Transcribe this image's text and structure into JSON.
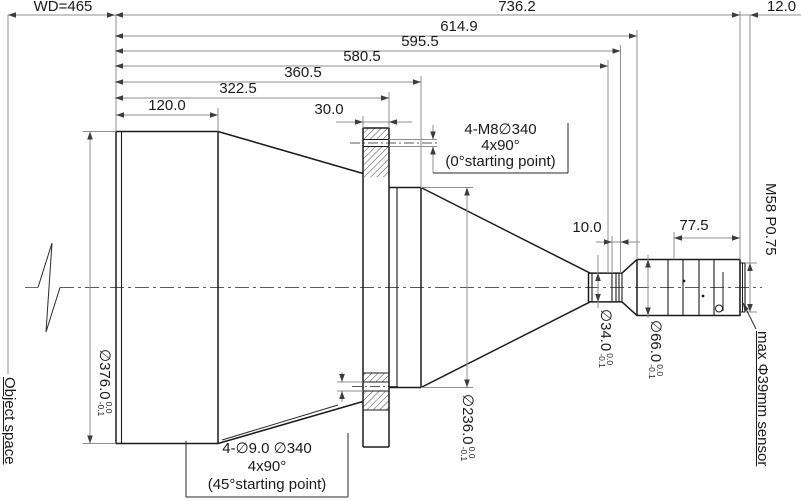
{
  "drawing": {
    "title": "telecentric lens mechanical dimension drawing",
    "dims": {
      "wd": "WD=465",
      "d736": "736.2",
      "d614": "614.9",
      "d595": "595.5",
      "d580": "580.5",
      "d360": "360.5",
      "d322": "322.5",
      "d120": "120.0",
      "d30": "30.0",
      "d10": "10.0",
      "d77": "77.5",
      "d12": "12.0"
    },
    "diameters": {
      "d376": "∅376.0",
      "d236": "∅236.0",
      "d34": "∅34.0",
      "d66": "∅66.0",
      "tol_upper": "0.0",
      "tol_lower": "-0.1"
    },
    "labels": {
      "m8_line1": "4-M8∅340",
      "m8_line2": "4x90°",
      "m8_line3": "(0°starting point)",
      "bolt_line1": "4-∅9.0 ∅340",
      "bolt_line2": "4x90°",
      "bolt_line3": "(45°starting point)",
      "m58": "M58 P0.75",
      "sensor": "max Φ39mm sensor",
      "object_space": "Object space"
    }
  }
}
